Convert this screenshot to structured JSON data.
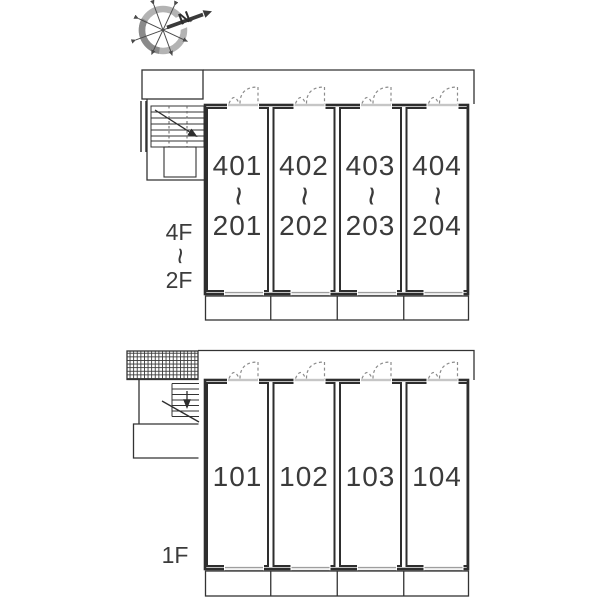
{
  "compass": {
    "north_label": "N"
  },
  "upper_floors_plan": {
    "side_label": {
      "top": "4F",
      "separator": "~",
      "bottom": "2F"
    },
    "units": [
      {
        "top": "401",
        "separator": "~",
        "bottom": "201"
      },
      {
        "top": "402",
        "separator": "~",
        "bottom": "202"
      },
      {
        "top": "403",
        "separator": "~",
        "bottom": "203"
      },
      {
        "top": "404",
        "separator": "~",
        "bottom": "204"
      }
    ]
  },
  "first_floor_plan": {
    "side_label": "1F",
    "units": [
      {
        "number": "101"
      },
      {
        "number": "102"
      },
      {
        "number": "103"
      },
      {
        "number": "104"
      }
    ]
  },
  "colors": {
    "wall": "#2e2e2e",
    "thin_line": "#333333",
    "text": "#3b3b3b",
    "door_arc": "#8c8c8c",
    "compass_ring": "#b0b0b0"
  }
}
